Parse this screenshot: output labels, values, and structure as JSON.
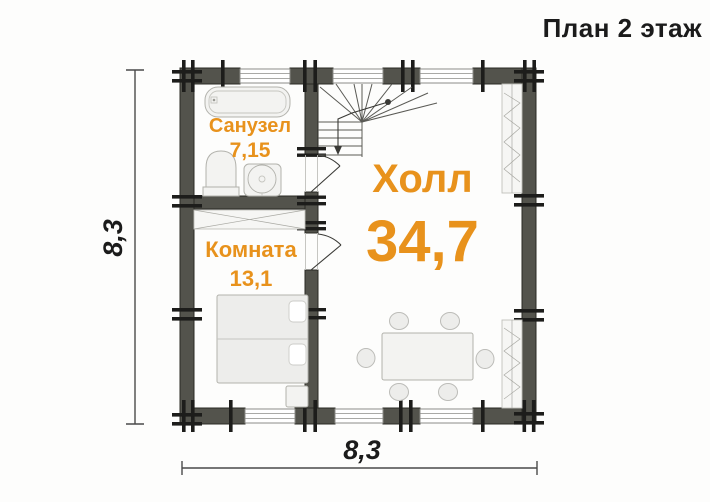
{
  "title": "План 2 этаж",
  "rooms": {
    "hall": {
      "name": "Холл",
      "area": "34,7"
    },
    "bathroom": {
      "name": "Санузел",
      "area": "7,15"
    },
    "bedroom": {
      "name": "Комната",
      "area": "13,1"
    }
  },
  "dimensions": {
    "height": "8,3",
    "width": "8,3"
  },
  "colors": {
    "accent": "#e8921c",
    "wall": "#53534c",
    "notch": "#1d1d1b",
    "ink": "#1b1b1b",
    "dim": "#4a4a4a"
  },
  "icons": {
    "bathtub": "bathtub-icon",
    "toilet": "toilet-icon",
    "sink": "sink-icon",
    "stairs": "stairs-icon",
    "stairs_direction": "down-arrow-icon",
    "bed": "bed-icon",
    "nightstand": "nightstand-icon",
    "dining_table": "dining-table-icon",
    "chair": "chair-icon",
    "wardrobe": "wardrobe-icon",
    "shelving": "shelving-icon",
    "window": "window-icon",
    "door": "door-swing-icon",
    "timber_notch": "log-notch-icon"
  }
}
